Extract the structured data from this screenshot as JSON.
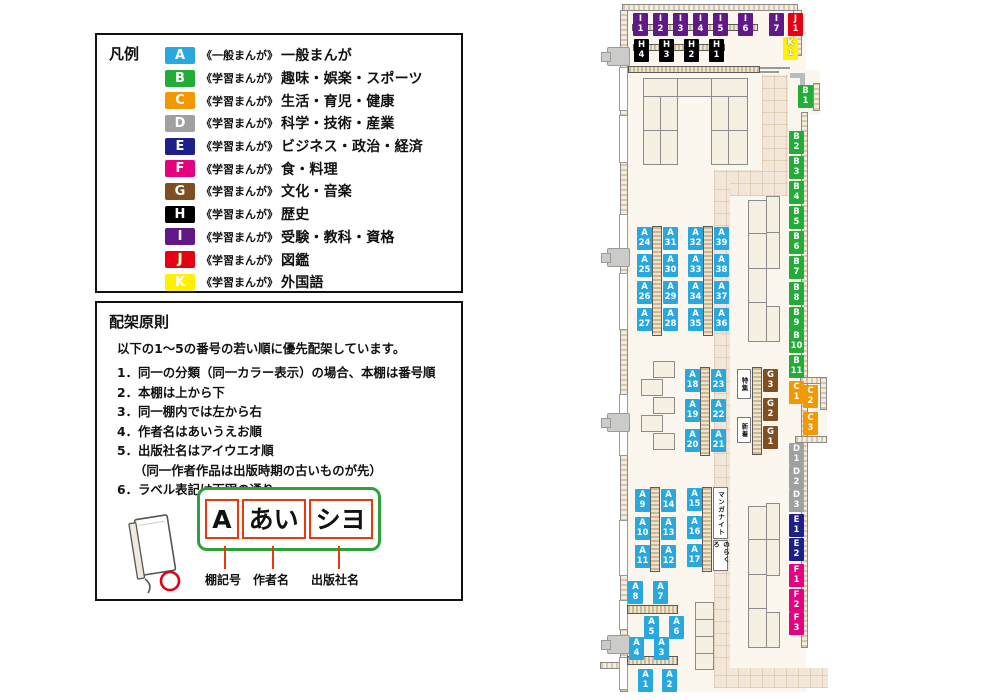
{
  "legend": {
    "title": "凡例",
    "items": [
      {
        "code": "A",
        "color": "#29A8E0",
        "series": "《一般まんが》",
        "category": "一般まんが"
      },
      {
        "code": "B",
        "color": "#22AC38",
        "series": "《学習まんが》",
        "category": "趣味・娯楽・スポーツ"
      },
      {
        "code": "C",
        "color": "#F39800",
        "series": "《学習まんが》",
        "category": "生活・育児・健康"
      },
      {
        "code": "D",
        "color": "#9FA0A0",
        "series": "《学習まんが》",
        "category": "科学・技術・産業"
      },
      {
        "code": "E",
        "color": "#1D2088",
        "series": "《学習まんが》",
        "category": "ビジネス・政治・経済"
      },
      {
        "code": "F",
        "color": "#E4007F",
        "series": "《学習まんが》",
        "category": "食・料理"
      },
      {
        "code": "G",
        "color": "#7F4F21",
        "series": "《学習まんが》",
        "category": "文化・音楽"
      },
      {
        "code": "H",
        "color": "#000000",
        "series": "《学習まんが》",
        "category": "歴史"
      },
      {
        "code": "I",
        "color": "#601986",
        "series": "《学習まんが》",
        "category": "受験・教科・資格"
      },
      {
        "code": "J",
        "color": "#E60012",
        "series": "《学習まんが》",
        "category": "図鑑"
      },
      {
        "code": "K",
        "color": "#FFF100",
        "series": "《学習まんが》",
        "category": "外国語"
      }
    ]
  },
  "principles": {
    "title": "配架原則",
    "intro": "以下の1～5の番号の若い順に優先配架しています。",
    "rules": [
      {
        "text": "1．同一の分類（同一カラー表示）の場合、本棚は番号順"
      },
      {
        "text": "2．本棚は上から下"
      },
      {
        "text": "3．同一棚内では左から右"
      },
      {
        "text": "4．作者名はあいうえお順"
      },
      {
        "text": "5．出版社名はアイウエオ順"
      },
      {
        "text": "（同一作者作品は出版時期の古いものが先）",
        "cls": "indent"
      },
      {
        "text": "6．ラベル表記は下図の通り"
      }
    ],
    "label_example": {
      "parts": [
        {
          "text": "A"
        },
        {
          "text": "あい"
        },
        {
          "text": "シヨ"
        }
      ],
      "captions": [
        {
          "text": "棚記号"
        },
        {
          "text": "作者名"
        },
        {
          "text": "出版社名"
        }
      ]
    }
  },
  "map": {
    "colors": {
      "A": "#29A8E0",
      "B": "#22AC38",
      "C": "#F39800",
      "D": "#9FA0A0",
      "E": "#1D2088",
      "F": "#E4007F",
      "G": "#7F4F21",
      "H": "#000000",
      "I": "#601986",
      "J": "#E60012",
      "K": "#FFF100"
    },
    "labels": [
      {
        "id": "I1",
        "cat": "I",
        "num": "1",
        "x": 633,
        "y": 13
      },
      {
        "id": "I2",
        "cat": "I",
        "num": "2",
        "x": 653,
        "y": 13
      },
      {
        "id": "I3",
        "cat": "I",
        "num": "3",
        "x": 673,
        "y": 13
      },
      {
        "id": "I4",
        "cat": "I",
        "num": "4",
        "x": 693,
        "y": 13
      },
      {
        "id": "I5",
        "cat": "I",
        "num": "5",
        "x": 713,
        "y": 13
      },
      {
        "id": "I6",
        "cat": "I",
        "num": "6",
        "x": 738,
        "y": 13
      },
      {
        "id": "I7",
        "cat": "I",
        "num": "7",
        "x": 769,
        "y": 13
      },
      {
        "id": "J1",
        "cat": "J",
        "num": "1",
        "x": 788,
        "y": 13
      },
      {
        "id": "K1",
        "cat": "K",
        "num": "1",
        "x": 783,
        "y": 37
      },
      {
        "id": "H4",
        "cat": "H",
        "num": "4",
        "x": 634,
        "y": 39
      },
      {
        "id": "H3",
        "cat": "H",
        "num": "3",
        "x": 659,
        "y": 39
      },
      {
        "id": "H2",
        "cat": "H",
        "num": "2",
        "x": 684,
        "y": 39
      },
      {
        "id": "H1",
        "cat": "H",
        "num": "1",
        "x": 709,
        "y": 39
      },
      {
        "id": "B1",
        "cat": "B",
        "num": "1",
        "x": 798,
        "y": 85
      },
      {
        "id": "B2",
        "cat": "B",
        "num": "2",
        "x": 789,
        "y": 131
      },
      {
        "id": "B3",
        "cat": "B",
        "num": "3",
        "x": 789,
        "y": 156
      },
      {
        "id": "B4",
        "cat": "B",
        "num": "4",
        "x": 789,
        "y": 181
      },
      {
        "id": "B5",
        "cat": "B",
        "num": "5",
        "x": 789,
        "y": 206
      },
      {
        "id": "B6",
        "cat": "B",
        "num": "6",
        "x": 789,
        "y": 231
      },
      {
        "id": "B7",
        "cat": "B",
        "num": "7",
        "x": 789,
        "y": 256
      },
      {
        "id": "B8",
        "cat": "B",
        "num": "8",
        "x": 789,
        "y": 282
      },
      {
        "id": "B9",
        "cat": "B",
        "num": "9",
        "x": 789,
        "y": 307
      },
      {
        "id": "B10",
        "cat": "B",
        "num": "10",
        "x": 789,
        "y": 330
      },
      {
        "id": "B11",
        "cat": "B",
        "num": "11",
        "x": 789,
        "y": 355
      },
      {
        "id": "C1",
        "cat": "C",
        "num": "1",
        "x": 789,
        "y": 381
      },
      {
        "id": "C2",
        "cat": "C",
        "num": "2",
        "x": 803,
        "y": 385
      },
      {
        "id": "C3",
        "cat": "C",
        "num": "3",
        "x": 803,
        "y": 412
      },
      {
        "id": "D1",
        "cat": "D",
        "num": "1",
        "x": 789,
        "y": 443
      },
      {
        "id": "D2",
        "cat": "D",
        "num": "2",
        "x": 789,
        "y": 466
      },
      {
        "id": "D3",
        "cat": "D",
        "num": "3",
        "x": 789,
        "y": 489
      },
      {
        "id": "E1",
        "cat": "E",
        "num": "1",
        "x": 789,
        "y": 514
      },
      {
        "id": "E2",
        "cat": "E",
        "num": "2",
        "x": 789,
        "y": 538
      },
      {
        "id": "F1",
        "cat": "F",
        "num": "1",
        "x": 789,
        "y": 564
      },
      {
        "id": "F2",
        "cat": "F",
        "num": "2",
        "x": 789,
        "y": 589
      },
      {
        "id": "F3",
        "cat": "F",
        "num": "3",
        "x": 789,
        "y": 612
      },
      {
        "id": "A24",
        "cat": "A",
        "num": "24",
        "x": 637,
        "y": 227
      },
      {
        "id": "A25",
        "cat": "A",
        "num": "25",
        "x": 637,
        "y": 254
      },
      {
        "id": "A26",
        "cat": "A",
        "num": "26",
        "x": 637,
        "y": 281
      },
      {
        "id": "A27",
        "cat": "A",
        "num": "27",
        "x": 637,
        "y": 308
      },
      {
        "id": "A31",
        "cat": "A",
        "num": "31",
        "x": 663,
        "y": 227
      },
      {
        "id": "A30",
        "cat": "A",
        "num": "30",
        "x": 663,
        "y": 254
      },
      {
        "id": "A29",
        "cat": "A",
        "num": "29",
        "x": 663,
        "y": 281
      },
      {
        "id": "A28",
        "cat": "A",
        "num": "28",
        "x": 663,
        "y": 308
      },
      {
        "id": "A32",
        "cat": "A",
        "num": "32",
        "x": 688,
        "y": 227
      },
      {
        "id": "A33",
        "cat": "A",
        "num": "33",
        "x": 688,
        "y": 254
      },
      {
        "id": "A34",
        "cat": "A",
        "num": "34",
        "x": 688,
        "y": 281
      },
      {
        "id": "A35",
        "cat": "A",
        "num": "35",
        "x": 688,
        "y": 308
      },
      {
        "id": "A39",
        "cat": "A",
        "num": "39",
        "x": 714,
        "y": 227
      },
      {
        "id": "A38",
        "cat": "A",
        "num": "38",
        "x": 714,
        "y": 254
      },
      {
        "id": "A37",
        "cat": "A",
        "num": "37",
        "x": 714,
        "y": 281
      },
      {
        "id": "A36",
        "cat": "A",
        "num": "36",
        "x": 714,
        "y": 308
      },
      {
        "id": "A18",
        "cat": "A",
        "num": "18",
        "x": 685,
        "y": 369
      },
      {
        "id": "A19",
        "cat": "A",
        "num": "19",
        "x": 685,
        "y": 399
      },
      {
        "id": "A20",
        "cat": "A",
        "num": "20",
        "x": 685,
        "y": 429
      },
      {
        "id": "A23",
        "cat": "A",
        "num": "23",
        "x": 711,
        "y": 369
      },
      {
        "id": "A22",
        "cat": "A",
        "num": "22",
        "x": 711,
        "y": 399
      },
      {
        "id": "A21",
        "cat": "A",
        "num": "21",
        "x": 711,
        "y": 429
      },
      {
        "id": "G3",
        "cat": "G",
        "num": "3",
        "x": 763,
        "y": 369
      },
      {
        "id": "G2",
        "cat": "G",
        "num": "2",
        "x": 763,
        "y": 398
      },
      {
        "id": "G1",
        "cat": "G",
        "num": "1",
        "x": 763,
        "y": 426
      },
      {
        "id": "A9",
        "cat": "A",
        "num": "9",
        "x": 635,
        "y": 489
      },
      {
        "id": "A10",
        "cat": "A",
        "num": "10",
        "x": 635,
        "y": 517
      },
      {
        "id": "A11",
        "cat": "A",
        "num": "11",
        "x": 635,
        "y": 545
      },
      {
        "id": "A14",
        "cat": "A",
        "num": "14",
        "x": 661,
        "y": 489
      },
      {
        "id": "A13",
        "cat": "A",
        "num": "13",
        "x": 661,
        "y": 517
      },
      {
        "id": "A12",
        "cat": "A",
        "num": "12",
        "x": 661,
        "y": 545
      },
      {
        "id": "A15",
        "cat": "A",
        "num": "15",
        "x": 687,
        "y": 488
      },
      {
        "id": "A16",
        "cat": "A",
        "num": "16",
        "x": 687,
        "y": 516
      },
      {
        "id": "A17",
        "cat": "A",
        "num": "17",
        "x": 687,
        "y": 544
      },
      {
        "id": "A8",
        "cat": "A",
        "num": "8",
        "x": 628,
        "y": 581
      },
      {
        "id": "A7",
        "cat": "A",
        "num": "7",
        "x": 653,
        "y": 581
      },
      {
        "id": "A5",
        "cat": "A",
        "num": "5",
        "x": 644,
        "y": 616
      },
      {
        "id": "A6",
        "cat": "A",
        "num": "6",
        "x": 669,
        "y": 616
      },
      {
        "id": "A4",
        "cat": "A",
        "num": "4",
        "x": 629,
        "y": 637
      },
      {
        "id": "A3",
        "cat": "A",
        "num": "3",
        "x": 654,
        "y": 637
      },
      {
        "id": "A1",
        "cat": "A",
        "num": "1",
        "x": 638,
        "y": 669
      },
      {
        "id": "A2",
        "cat": "A",
        "num": "2",
        "x": 662,
        "y": 669
      }
    ],
    "area_boxes": [
      {
        "text": "特集",
        "x": 737,
        "y": 369,
        "w": 14,
        "h": 30
      },
      {
        "text": "新着",
        "x": 737,
        "y": 417,
        "w": 14,
        "h": 26
      },
      {
        "text": "マンガナイト",
        "x": 713,
        "y": 487,
        "w": 15,
        "h": 52
      },
      {
        "text": "のらくろ",
        "x": 713,
        "y": 540,
        "w": 15,
        "h": 31
      }
    ]
  }
}
